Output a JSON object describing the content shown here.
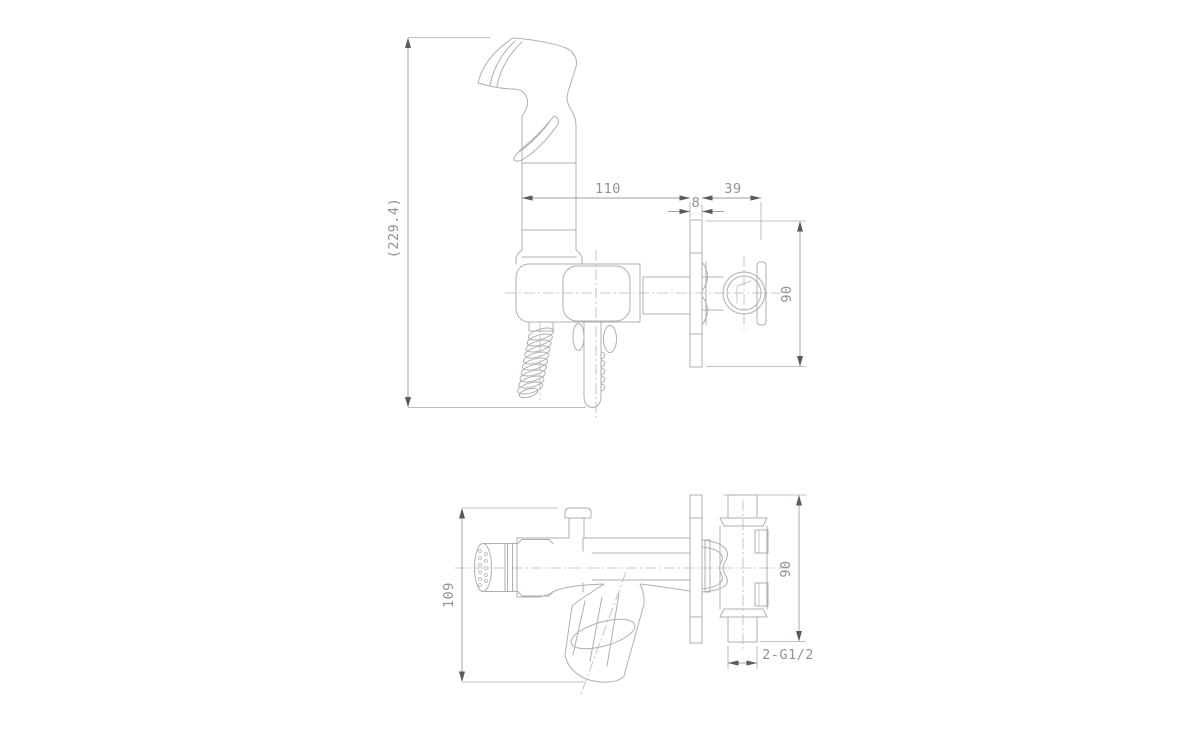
{
  "drawing": {
    "kind": "technical dimensional drawing",
    "subject": "wall-mounted hygienic shower / bidet sprayer set",
    "colors": {
      "background": "#ffffff",
      "line": "#abb0b5",
      "dimension_text": "#8d9398",
      "arrow": "#565b61"
    },
    "views": {
      "side": {
        "name": "side-elevation-view",
        "dims": {
          "overall_height": "(229.4)",
          "handle_to_wall": "110",
          "plate_thickness": "8",
          "connector_depth": "39",
          "plate_height": "90"
        }
      },
      "plan": {
        "name": "plan-view",
        "dims": {
          "overall_depth": "109",
          "plate_height": "90",
          "thread_callout": "2-G1/2"
        }
      }
    }
  }
}
